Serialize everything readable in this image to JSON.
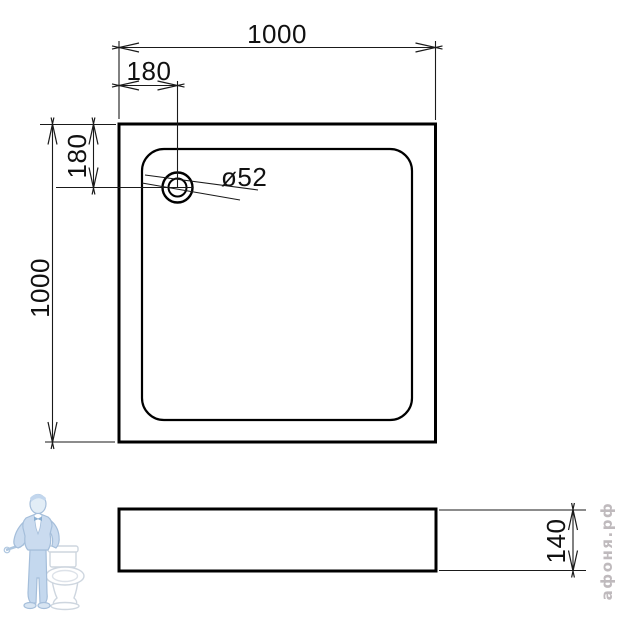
{
  "drawing": {
    "type": "technical-drawing-shower-tray",
    "views": {
      "top": {
        "width_dim": "1000",
        "height_dim": "1000",
        "drain_offset_horizontal_dim": "180",
        "drain_offset_vertical_dim": "180",
        "drain_diameter_dim": "ø52"
      },
      "side": {
        "height_dim": "140"
      }
    },
    "watermark": {
      "site": "афоня.рф"
    },
    "colors": {
      "line": "#000000",
      "watermark_figure_blue": "#bdd3ec",
      "watermark_figure_outline": "#8fafd2",
      "watermark_text_gray": "#b5aeb2"
    }
  }
}
